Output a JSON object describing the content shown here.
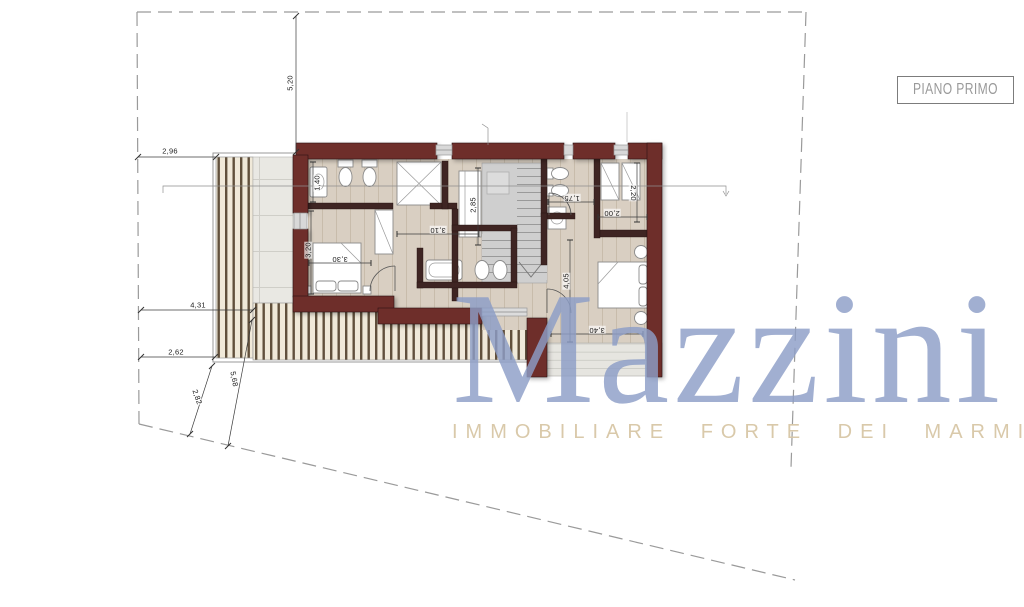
{
  "plan_label": {
    "text": "PIANO PRIMO"
  },
  "watermark": {
    "brand": "Mazzini",
    "tagline": "IMMOBILIARE FORTE DEI MARMI",
    "brand_color": "#8d9ec7",
    "tagline_color": "#d8c7a6"
  },
  "colors": {
    "wall": "#6e2f2c",
    "interior_wall": "#3f2523",
    "floor": "#d9cfc2",
    "marble": "#e9e8e3",
    "deck_bar": "#61503c",
    "deck_bg": "#f0e9d9",
    "stair": "#cfcfcf",
    "boundary": "#9a9a9a",
    "dimension_text": "#1b1b1b"
  },
  "dimensions": [
    {
      "value": "5,20",
      "x": 290,
      "y": 83,
      "rot": -90
    },
    {
      "value": "2,96",
      "x": 170,
      "y": 151,
      "rot": 0
    },
    {
      "value": "4,31",
      "x": 198,
      "y": 305,
      "rot": 0
    },
    {
      "value": "2,62",
      "x": 176,
      "y": 352,
      "rot": 0
    },
    {
      "value": "2,82",
      "x": 197,
      "y": 397,
      "rot": 71
    },
    {
      "value": "5,68",
      "x": 234,
      "y": 379,
      "rot": 79
    },
    {
      "value": "1,40",
      "x": 317,
      "y": 183,
      "rot": -90
    },
    {
      "value": "3,20",
      "x": 308,
      "y": 250,
      "rot": -90
    },
    {
      "value": "3,30",
      "x": 340,
      "y": 259,
      "rot": 180
    },
    {
      "value": "3,10",
      "x": 438,
      "y": 230,
      "rot": 180
    },
    {
      "value": "2,85",
      "x": 473,
      "y": 205,
      "rot": -90
    },
    {
      "value": "1,75",
      "x": 572,
      "y": 198,
      "rot": 180
    },
    {
      "value": "2,20",
      "x": 633,
      "y": 193,
      "rot": 90
    },
    {
      "value": "2,00",
      "x": 612,
      "y": 213,
      "rot": 180
    },
    {
      "value": "4,05",
      "x": 566,
      "y": 281,
      "rot": -90
    },
    {
      "value": "3,40",
      "x": 597,
      "y": 330,
      "rot": 180
    }
  ]
}
